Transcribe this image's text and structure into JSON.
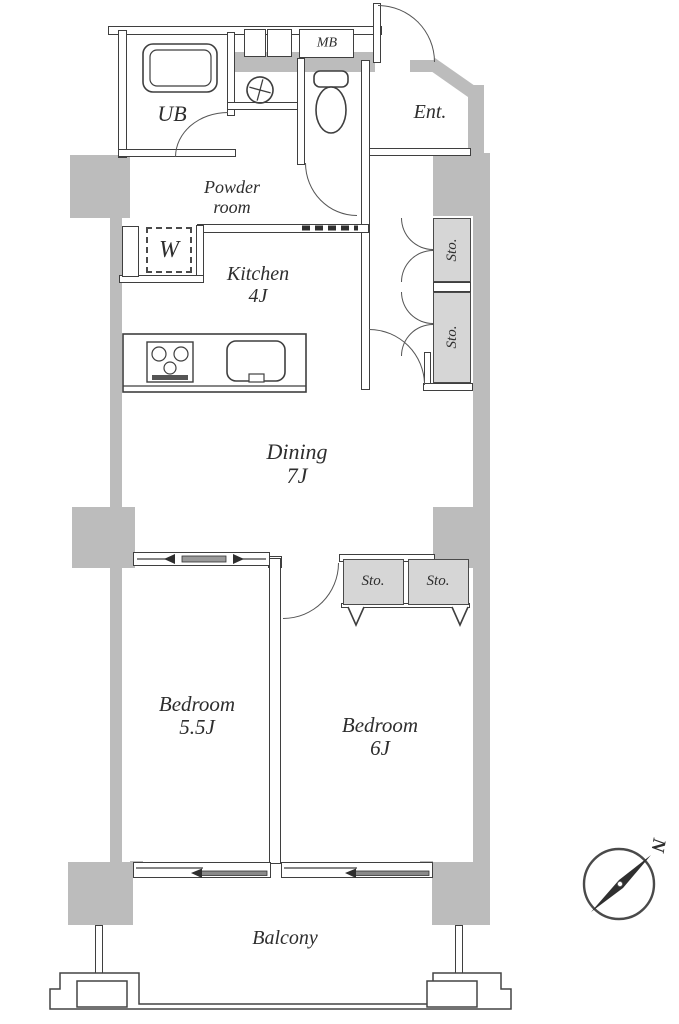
{
  "title": "apartment-floor-plan",
  "labels": {
    "ub": "UB",
    "mb": "MB",
    "entrance": "Ent.",
    "powder_line1": "Powder",
    "powder_line2": "room",
    "washer": "W",
    "kitchen_name": "Kitchen",
    "kitchen_size": "4J",
    "storage": "Sto.",
    "dining_name": "Dining",
    "dining_size": "7J",
    "bedroom_small_name": "Bedroom",
    "bedroom_small_size": "5.5J",
    "bedroom_large_name": "Bedroom",
    "bedroom_large_size": "6J",
    "balcony": "Balcony",
    "compass_north": "N"
  },
  "icons": {
    "compass": "compass-icon",
    "bathtub": "bathtub-icon",
    "toilet": "toilet-icon",
    "washbasin": "washbasin-icon",
    "stove": "stove-icon",
    "kitchen_sink": "kitchen-sink-icon"
  },
  "colors": {
    "wall_fill": "#bcbcbc",
    "closet_fill": "#d6d6d6",
    "line": "#3f3f3f",
    "text": "#2e2e2e"
  }
}
